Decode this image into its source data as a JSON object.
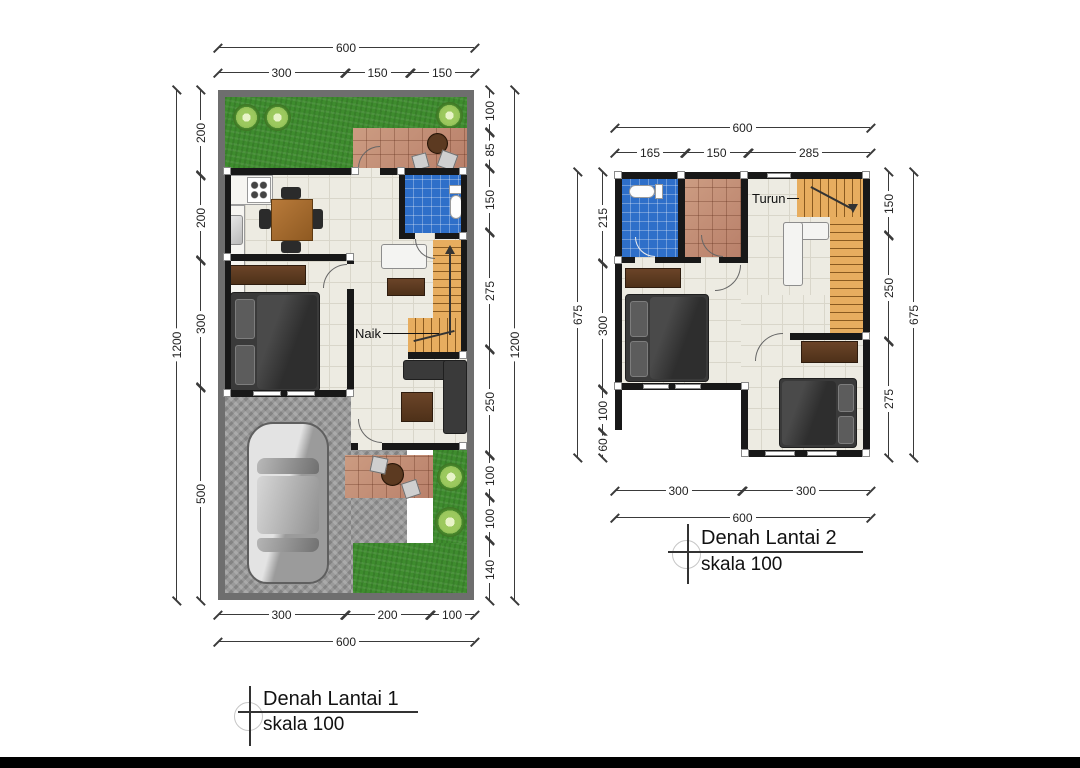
{
  "plan1": {
    "title": "Denah Lantai 1",
    "scale_label": "skala 100",
    "stair_label": "Naik",
    "dims": {
      "top_total": "600",
      "top_segments": [
        "300",
        "150",
        "150"
      ],
      "left_total": "1200",
      "left_segments": [
        "200",
        "200",
        "300",
        "500"
      ],
      "right_total": "1200",
      "right_segments": [
        "100",
        "85",
        "150",
        "275",
        "250",
        "100",
        "100",
        "140"
      ],
      "bottom_segments": [
        "300",
        "200",
        "100"
      ],
      "bottom_total": "600"
    }
  },
  "plan2": {
    "title": "Denah Lantai 2",
    "scale_label": "skala 100",
    "stair_label": "Turun",
    "dims": {
      "top_total": "600",
      "top_segments": [
        "165",
        "150",
        "285"
      ],
      "left_total": "675",
      "left_segments": [
        "215",
        "300",
        "100",
        "60"
      ],
      "right_total": "675",
      "right_segments": [
        "150",
        "250",
        "275"
      ],
      "bottom_segments": [
        "300",
        "300"
      ],
      "bottom_total": "600"
    }
  },
  "colors": {
    "site_border": "#6e6e6e",
    "wall": "#181818",
    "floor": "#edebe2",
    "grass": "#3e8c2e",
    "bathroom_blue": "#2e6fc9",
    "terrace_tile": "#c austere",
    "stair_tan": "#e7ad5f",
    "paving_gray": "#9a9a9a"
  }
}
